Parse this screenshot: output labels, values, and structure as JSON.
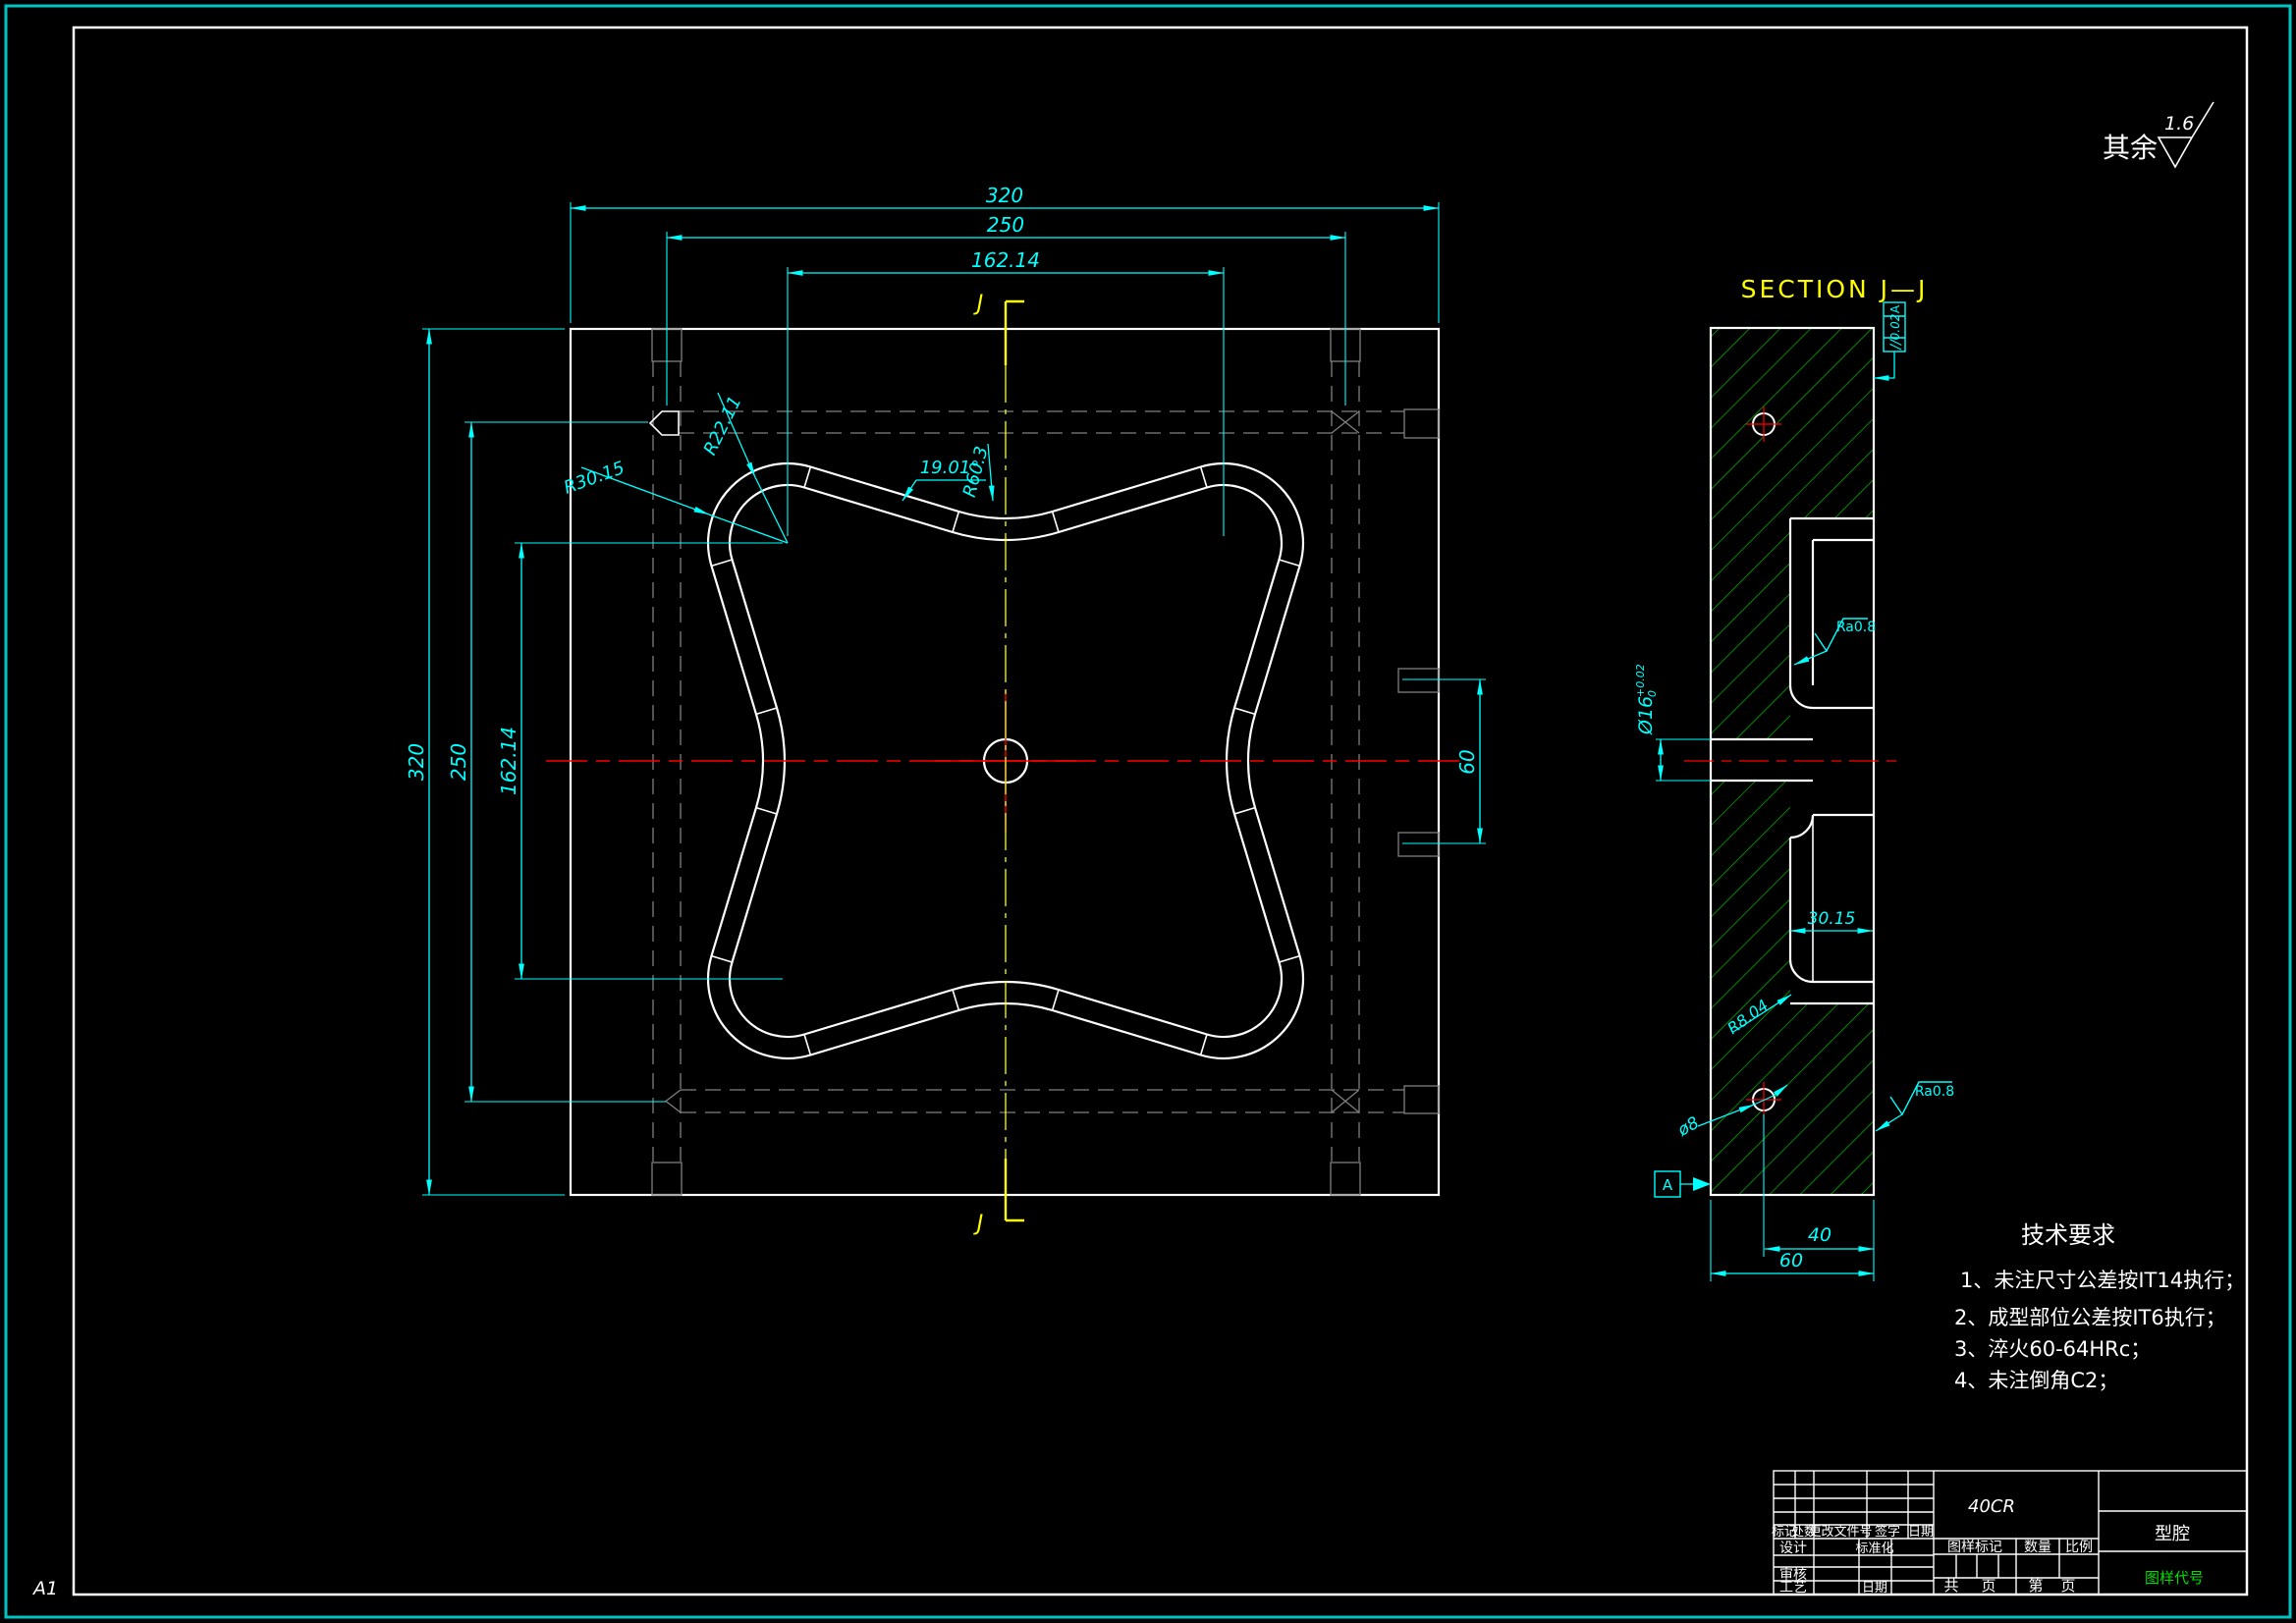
{
  "sheet": {
    "format_label": "A1"
  },
  "colors": {
    "background": "#000000",
    "outline_white": "#ffffff",
    "dimension_cyan": "#00ffff",
    "centerline_red": "#ff0000",
    "section_yellow": "#ffff00",
    "hatch_green": "#00bf00",
    "hidden_gray": "#7f7f7f",
    "border_teal": "#00c4c4",
    "code_green": "#00e000"
  },
  "surface_note": {
    "prefix": "其余",
    "value": "1.6"
  },
  "plan": {
    "section_mark": "J",
    "dims": {
      "top_320": "320",
      "top_250": "250",
      "top_162": "162.14",
      "left_320": "320",
      "left_250": "250",
      "left_162": "162.14",
      "right_60": "60",
      "r_lobe_outer": "R30.15",
      "r_lobe_inner": "R22.11",
      "angle": "19.01°",
      "r_valley": "R60.3"
    }
  },
  "section": {
    "title": "SECTION J—J",
    "gdt": {
      "symbol": "//",
      "value": "0.02",
      "datum": "A"
    },
    "datum_label": "A",
    "roughness": "Ra0.8",
    "dims": {
      "hole_dia": "Ø16",
      "hole_tol_up": "+0.02",
      "hole_tol_dn": "0",
      "depth": "30.15",
      "fillet": "R8.04",
      "small_hole": "ø8",
      "offset_40": "40",
      "thick_60": "60"
    }
  },
  "tech": {
    "title": "技术要求",
    "items": [
      "1、未注尺寸公差按IT14执行；",
      "2、成型部位公差按IT6执行；",
      "3、淬火60-64HRc；",
      "4、未注倒角C2；"
    ]
  },
  "titleblock": {
    "material": "40CR",
    "part_name": "型腔",
    "drawing_code": "图样代号",
    "mark": "标记",
    "count": "处数",
    "doc": "更改文件号",
    "sign": "签字",
    "date": "日期",
    "design": "设计",
    "standard": "标准化",
    "audit": "审核",
    "process": "工艺",
    "date2": "日期",
    "stamp": "图样标记",
    "qty": "数量",
    "scale": "比例",
    "total": "共",
    "page": "页",
    "no": "第",
    "page2": "页"
  }
}
